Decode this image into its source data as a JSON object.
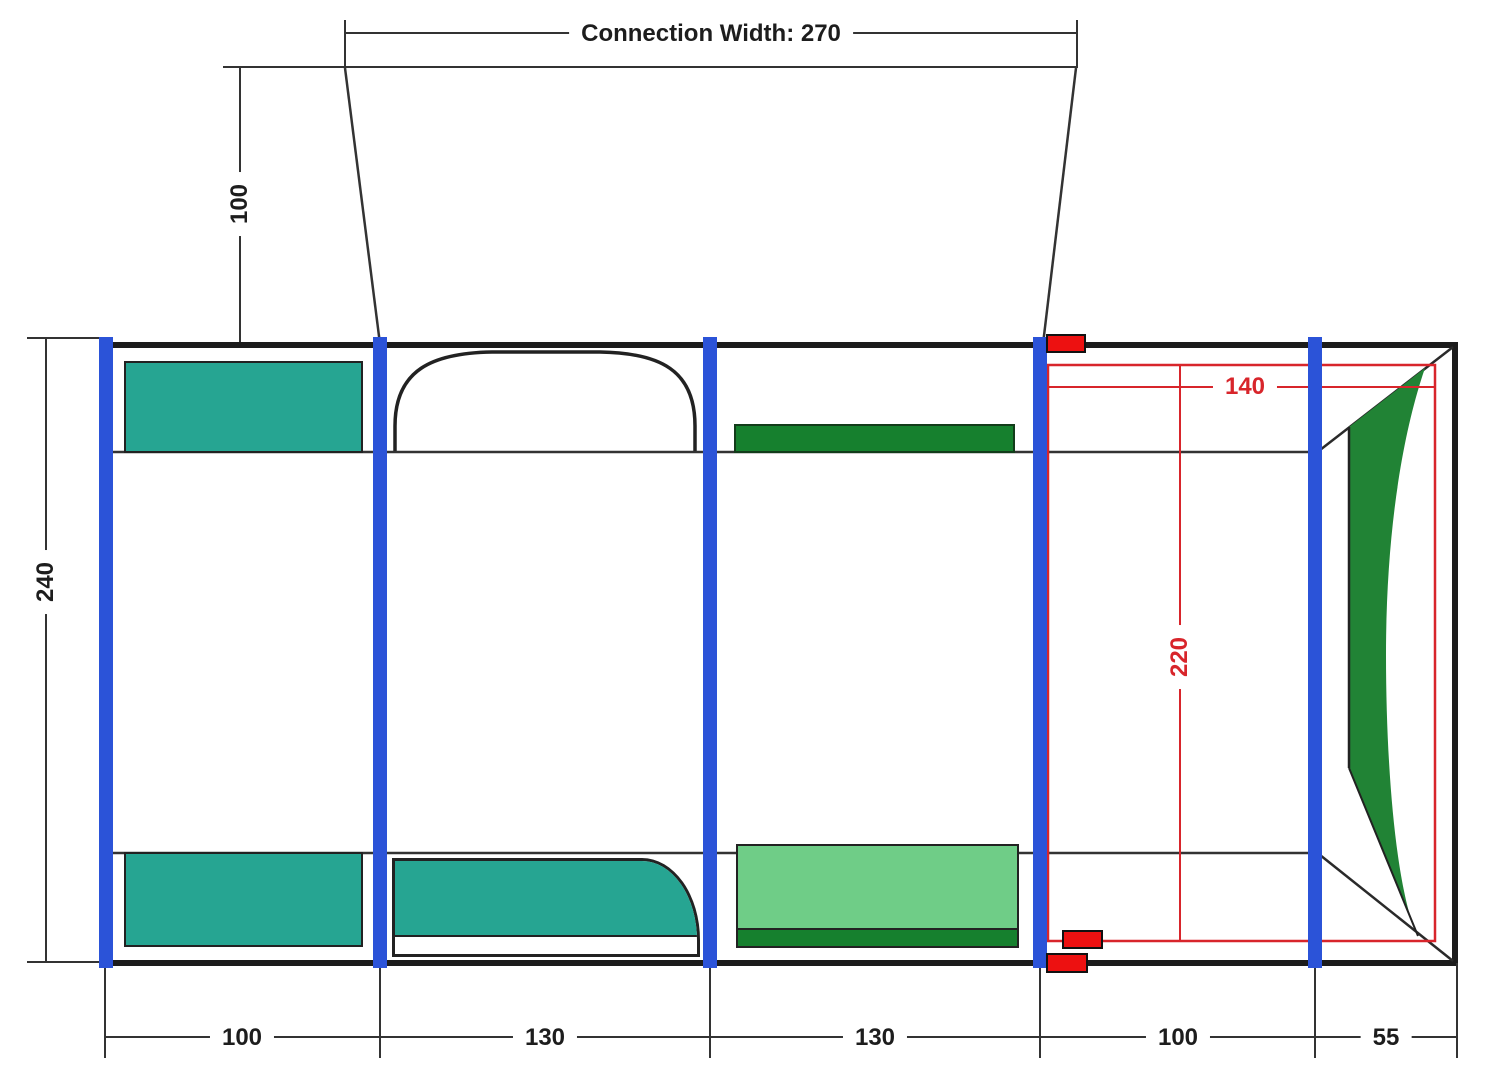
{
  "diagram": {
    "connection_width_label": "Connection Width: 270",
    "tunnel_depth": "100",
    "total_depth": "240",
    "inner_width": "140",
    "inner_depth": "220",
    "bottom_segments": [
      "100",
      "130",
      "130",
      "100",
      "55"
    ]
  },
  "colors": {
    "pole_blue": "#2b53d8",
    "teal": "#26a592",
    "green_dark": "#16802e",
    "green_light": "#6fcd87",
    "curtain_green": "#218335",
    "marker_red": "#ed1111",
    "dim_red": "#d8252b",
    "line_black": "#222222",
    "border_black": "#1c1c1c",
    "text_black": "#1d1d1d"
  }
}
